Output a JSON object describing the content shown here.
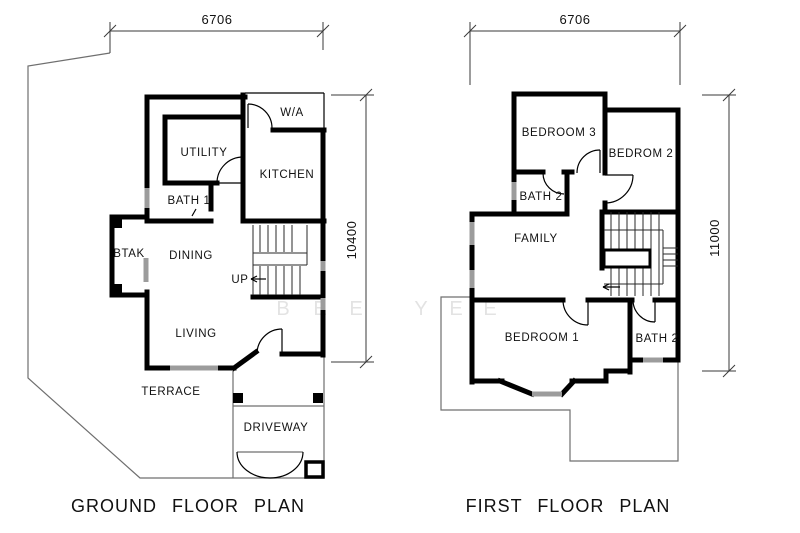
{
  "ground_plan": {
    "title": "GROUND FLOOR PLAN",
    "width_dim": "6706",
    "height_dim": "10400",
    "rooms": {
      "wa": "W/A",
      "utility": "UTILITY",
      "kitchen": "KITCHEN",
      "bath1": "BATH  1",
      "btak": "BTAK",
      "dining": "DINING",
      "up": "UP",
      "living": "LIVING",
      "terrace": "TERRACE",
      "driveway": "DRIVEWAY"
    }
  },
  "first_plan": {
    "title": "FIRST FLOOR PLAN",
    "width_dim": "6706",
    "height_dim": "11000",
    "rooms": {
      "bedroom3": "BEDROOM 3",
      "bedroom2": "BEDROM 2",
      "bath2_upper": "BATH  2",
      "family": "FAMILY",
      "bedroom1": "BEDROOM 1",
      "bath2_lower": "BATH 2"
    }
  },
  "watermark": {
    "letters": [
      "B",
      "E",
      "E",
      "Y",
      "E",
      "E"
    ]
  },
  "colors": {
    "wall": "#000000",
    "site_boundary": "#6f6f6f",
    "window": "#9c9c9c",
    "watermark": "#e3e3e3",
    "background": "#ffffff"
  }
}
